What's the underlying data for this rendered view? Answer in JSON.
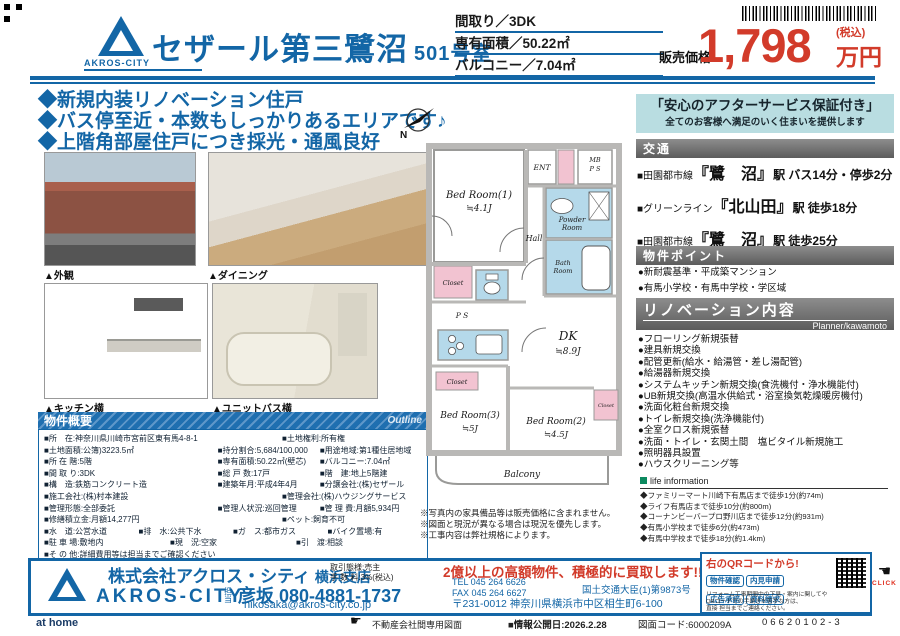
{
  "header": {
    "logo_text": "AKROS-CITY",
    "title": "セザール第三鷺沼",
    "unit": "501号室",
    "specs": [
      {
        "label": "間取り",
        "value": "3DK"
      },
      {
        "label": "専有面積",
        "value": "50.22㎡"
      },
      {
        "label": "バルコニー",
        "value": "7.04㎡"
      }
    ],
    "price_label": "販売価格",
    "price_value": "1,798",
    "price_tax": "(税込)",
    "price_unit": "万円"
  },
  "catch_copy": {
    "line1": "◆新規内装リノベーション住戸",
    "line2": "◆バス停至近・本数もしっかりあるエリアです♪",
    "line3": "◆上階角部屋住戸につき採光・通風良好"
  },
  "photos": {
    "exterior_caption": "▲外観",
    "dining_caption": "▲ダイニング",
    "kitchen_caption": "▲キッチン横",
    "bath_caption": "▲ユニットバス横"
  },
  "outline": {
    "title": "物件概要",
    "title_en": "Outline",
    "rows": [
      [
        "■所　在:神奈川県川崎市宮前区東有馬4-8-1",
        "■土地権利:所有権"
      ],
      [
        "■土地面積:公簿)3223.5㎡",
        "■持分割合:5,684/100,000",
        "■用途地域:第1種住居地域"
      ],
      [
        "■所 在 階:5階",
        "■専有面積:50.22㎡(壁芯)",
        "■バルコニー:7.04㎡"
      ],
      [
        "■間 取 り:3DK",
        "■総 戸 数:17戸",
        "■階　建:地上5階建"
      ],
      [
        "■構　造:鉄筋コンクリート造",
        "■建築年月:平成4年4月",
        "■分譲会社:(株)セザール"
      ],
      [
        "■施工会社:(株)村本建設",
        "■管理会社:(株)ハウジングサービス"
      ],
      [
        "■管理形態:全部委託",
        "■管理人状況:巡回管理",
        "■管 理 費:月額5,934円"
      ],
      [
        "■修繕積立金:月額14,277円",
        "■ペット:飼育不可"
      ],
      [
        "■水　道:公営水道",
        "■排　水:公共下水",
        "■ガ　ス:都市ガス",
        "■バイク置場:有"
      ],
      [
        "■駐 車 場:敷地内",
        "■現　況:空家",
        "■引　渡:相談"
      ],
      [
        "■そ の 他:詳細費用等は担当までご確認ください"
      ]
    ]
  },
  "floorplan": {
    "north": "N",
    "labels": {
      "bed1": "Bed Room(1)",
      "bed1s": "≒4.1J",
      "ent": "ENT",
      "mb": "MB",
      "ps": "P S",
      "powder1": "Powder",
      "powder2": "Room",
      "bath1": "Bath",
      "bath2": "Room",
      "hall": "Hall",
      "closet1": "Closet",
      "ps2": "P S",
      "dk": "DK",
      "dks": "≒8.9J",
      "closet2": "Closet",
      "bed3": "Bed Room(3)",
      "bed3s": "≒5J",
      "bed2": "Bed Room(2)",
      "bed2s": "≒4.5J",
      "closet3": "Closet",
      "balcony": "Balcony"
    },
    "notes": {
      "n1": "※写真内の家具備品等は販売価格に含まれません。",
      "n2": "※図面と現況が異なる場合は現況を優先します。",
      "n3": "※工事内容は弊社規格によります。"
    }
  },
  "right_panel": {
    "guarantee_title": "「安心のアフターサービス保証付き」",
    "guarantee_sub": "全てのお客様へ満足のいく住まいを提供します",
    "traffic_title": "交通",
    "transit": [
      {
        "line": "■田園都市線",
        "station": "『鷺　沼』",
        "detail": "駅 バス14分・停歩2分"
      },
      {
        "line": "■グリーンライン",
        "station": "『北山田』",
        "detail": "駅 徒歩18分"
      },
      {
        "line": "■田園都市線",
        "station": "『鷺　沼』",
        "detail": "駅 徒歩25分"
      }
    ],
    "points_title": "物件ポイント",
    "points": [
      "●新耐震基準・平成築マンション",
      "●有馬小学校・有馬中学校・学区域"
    ],
    "reno_title": "リノベーション内容",
    "reno_planner": "Planner/kawamoto",
    "reno_items": [
      "●フローリング新規張替",
      "●建具新規交換",
      "●配管更新(給水・給湯管・差し湯配管)",
      "●給湯器新規交換",
      "●システムキッチン新規交換(食洗機付・浄水機能付)",
      "●UB新規交換(高温水供給式・浴室換気乾燥暖房機付)",
      "●洗面化粧台新規交換",
      "●トイレ新規交換(洗浄機能付)",
      "●全室クロス新規張替",
      "●洗面・トイレ・玄関土間　塩ビタイル新規施工",
      "●照明器具設置",
      "●ハウスクリーニング等"
    ],
    "life_title": "life information",
    "life_items": [
      "◆ファミリーマート川崎下有馬店まで徒歩1分(約74m)",
      "◆ライフ有馬店まで徒歩10分(約800m)",
      "◆コーナンビーバープロ野川店まで徒歩12分(約931m)",
      "◆有馬小学校まで徒歩6分(約473m)",
      "◆有馬中学校まで徒歩18分(約1.4km)"
    ]
  },
  "bottom": {
    "company": "株式会社アクロス・シティ",
    "branch": "横浜支店",
    "deal1": "取引態様:売主",
    "deal2": "手 数 料:3%(税込)",
    "logo_text": "AKROS-CITY",
    "contact_label": "担当",
    "contact_phone": "彦坂 080-4881-1737",
    "contact_mail": "hikosaka@akros-city.co.jp",
    "tel": "TEL 045 264 6626",
    "fax": "FAX 045 264 6627",
    "license": "国土交通大臣(1)第9873号",
    "address": "〒231-0012 神奈川県横浜市中区相生町6-100",
    "promo": "2億以上の高額物件、積極的に買取します!!",
    "qr_lead": "右のQRコードから!",
    "qr_buttons": [
      "物件確認",
      "内見申請",
      "広告承諾",
      "資料請求"
    ],
    "qr_note1": "リフォーム工事期間中の下見・案内に関してや",
    "qr_note2": "QRコードでの手続きが苦手な方は、",
    "qr_note3": "直接 担当までご連絡ください。",
    "click": "CLICK"
  },
  "footer": {
    "athome": "at home",
    "doc_type": "不動産会社間専用図面",
    "release": "■情報公開日:2026.2.28",
    "code": "図面コード:6000209A",
    "serial": "06620102-3"
  }
}
